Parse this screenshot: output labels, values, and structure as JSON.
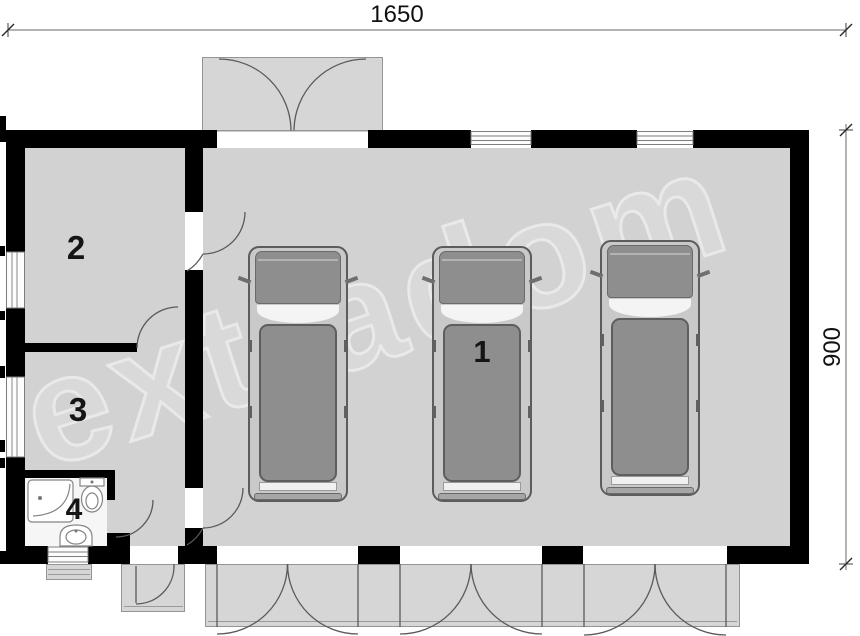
{
  "plan": {
    "title": "garage-floor-plan",
    "dimensions": {
      "width_label": "1650",
      "height_label": "900"
    },
    "watermark": "extradom",
    "rooms": {
      "garage_label": "1",
      "room2_label": "2",
      "room3_label": "3",
      "bathroom_label": "4"
    },
    "vehicle_count": 3,
    "fixtures": [
      "shower",
      "toilet",
      "washbasin"
    ],
    "colors": {
      "wall": "#000000",
      "floor": "#d2d2d2",
      "bathroom_floor": "#f6f6f6",
      "slab": "#d6d6d6",
      "line": "#555555",
      "watermark": "#e9e9e9"
    }
  }
}
